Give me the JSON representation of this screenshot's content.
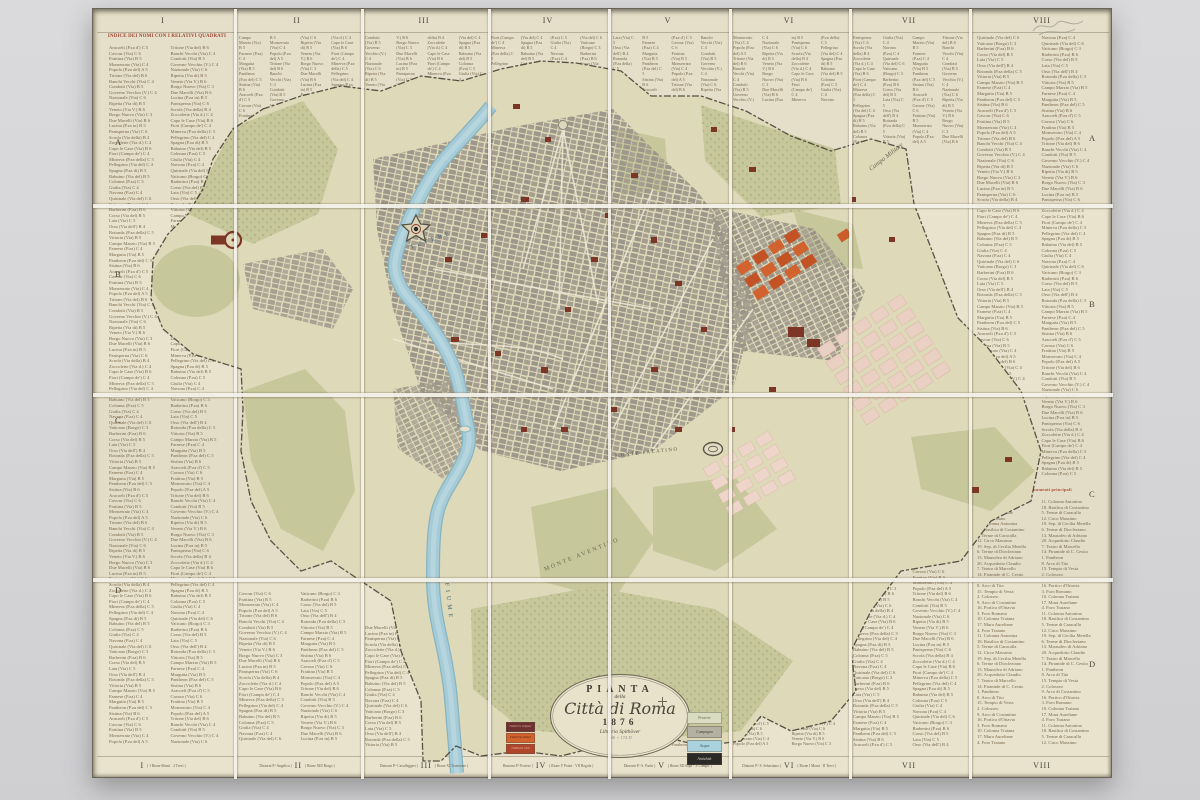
{
  "photo": {
    "background": "#d6d6d8",
    "surface": "#e9e3cd"
  },
  "map": {
    "grid": {
      "columns": [
        "I",
        "II",
        "III",
        "IV",
        "V",
        "VI",
        "VII",
        "VIII"
      ],
      "rows": [
        "A",
        "B",
        "C",
        "D"
      ]
    },
    "index": {
      "header": "INDICE DEI NOMI CON I RELATIVI QUADRATI",
      "monuments_header": "Elenco dei monumenti principali",
      "sample_entries": [
        "Aracoeli (P.za d') C 5",
        "Babuino (Via del) B 5",
        "Banchi Vecchi (Via) C 4",
        "Barberini (P.za) B 6",
        "Borgo Nuovo (Via) C 3",
        "Campo Marzio (Via) B 5",
        "Capo le Case (Via) B 6",
        "Cavour (Via) C 6",
        "Colonna (P.za) C 5",
        "Condotti (Via) B 5",
        "Corso (Via del) B 5",
        "Due Macelli (Via) B 6",
        "Farnese (P.za) C 4",
        "Fiori (Campo de') C 4",
        "Frattina (Via) B 5",
        "Giulia (Via) C 4",
        "Governo Vecchio (V.) C 4",
        "Lata (Via) C 5",
        "Lucina (P.za in) B 5",
        "Margutta (Via) B 5",
        "Minerva (P.za della) C 5",
        "Monserrato (Via) C 4",
        "Navona (P.za) C 4",
        "Nazionale (Via) C 6",
        "Orso (Via dell') B 4",
        "Panisperna (Via) C 6",
        "Pantheon (P.za del) C 5",
        "Pellegrino (Via del) C 4",
        "Popolo (P.za del) A 5",
        "Quirinale (Via del) C 6",
        "Ripetta (Via di) B 5",
        "Rotonda (P.za della) C 5",
        "Scrofa (Via della) B 4",
        "Sistina (Via) B 6",
        "Spagna (P.za di) B 5",
        "Tritone (Via del) B 6",
        "Vaticano (Borgo) C 3",
        "Veneto (Via V.) B 6",
        "Vittoria (Via) B 5",
        "Zoccolette (Via d.) C 4"
      ],
      "monuments": [
        "1. Pantheon",
        "2. Colosseo",
        "3. Foro Romano",
        "4. Foro Traiano",
        "5. Terme di Caracalla",
        "6. Terme di Diocleziano",
        "7. Teatro di Marcello",
        "8. Arco di Tito",
        "9. Arco di Costantino",
        "10. Colonna Traiana",
        "11. Colonna Antonina",
        "12. Circo Massimo",
        "13. Mausoleo di Adriano",
        "14. Piramide di C. Cestio",
        "15. Tempio di Vesta",
        "16. Portico d'Ottavia",
        "17. Mura Aureliane",
        "18. Basilica di Costantino",
        "19. Sep. di Cecilia Metella",
        "20. Acquedotto Claudio"
      ]
    },
    "title_cartouche": {
      "line1": "PIANTA",
      "line2": "della",
      "line3": "Città di Roma",
      "year": "1876",
      "publisher": "Libreria Spithöver",
      "pencil_note": "146 × 174 D"
    },
    "map_labels": {
      "river_upper": "TEVERE",
      "river_lower": "FIUME",
      "aventino": "MONTE AVENTINO",
      "palatino": "MONTE PALATINO",
      "campo_militare": "Campo Militare"
    },
    "legend": {
      "right": [
        {
          "label": "Praterie",
          "color": "#d9dcc0"
        },
        {
          "label": "Campagna",
          "color": "#b4b0a2"
        },
        {
          "label": "Acqua",
          "color": "#a9d2dc"
        },
        {
          "label": "Antichità",
          "color": "#2b2a26"
        }
      ],
      "left": [
        {
          "label": "Fabbriche religiose",
          "color": "#6f3030"
        },
        {
          "label": "Fabbriche militari",
          "color": "#d2622e"
        },
        {
          "label": "Fabbriche civili",
          "color": "#b0452c"
        }
      ]
    },
    "bottom_notes": [
      {
        "left": "",
        "right": "( 1 Rione Monti · 2 Trevi )"
      },
      {
        "left": "Dintorni P.ª Angelica )",
        "right": "( Rione XIII Borgo )"
      },
      {
        "left": "Dintorni P.ª Cavalleggeri )",
        "right": "( Rione XI Trastevere )"
      },
      {
        "left": "Dintorni P.ª Portese )",
        "right": "( Rione V Ponte · VII Regola )"
      },
      {
        "left": "Dintorni P.ª S. Paolo )",
        "right": "( Rione XII Ripa · X Campit. )"
      },
      {
        "left": "Dintorni P.ª S. Sebastiano )",
        "right": "( Rione I Monti · II Trevi )"
      },
      {
        "left": "",
        "right": ""
      },
      {
        "left": "",
        "right": ""
      }
    ],
    "colors": {
      "parchment": "#e9e3cd",
      "index_text": "#77674d",
      "header_red": "#9c4632",
      "terrain": "#ded9b8",
      "green": "#c6c79b",
      "built_gray": "#a29b8d",
      "river_blue": "#a6cbd6",
      "landmark_red": "#7d3526",
      "orange_block": "#d2622e",
      "pink_block": "#ead0c2",
      "wall": "#3f3a30",
      "fold": "#f4f2ea"
    }
  }
}
